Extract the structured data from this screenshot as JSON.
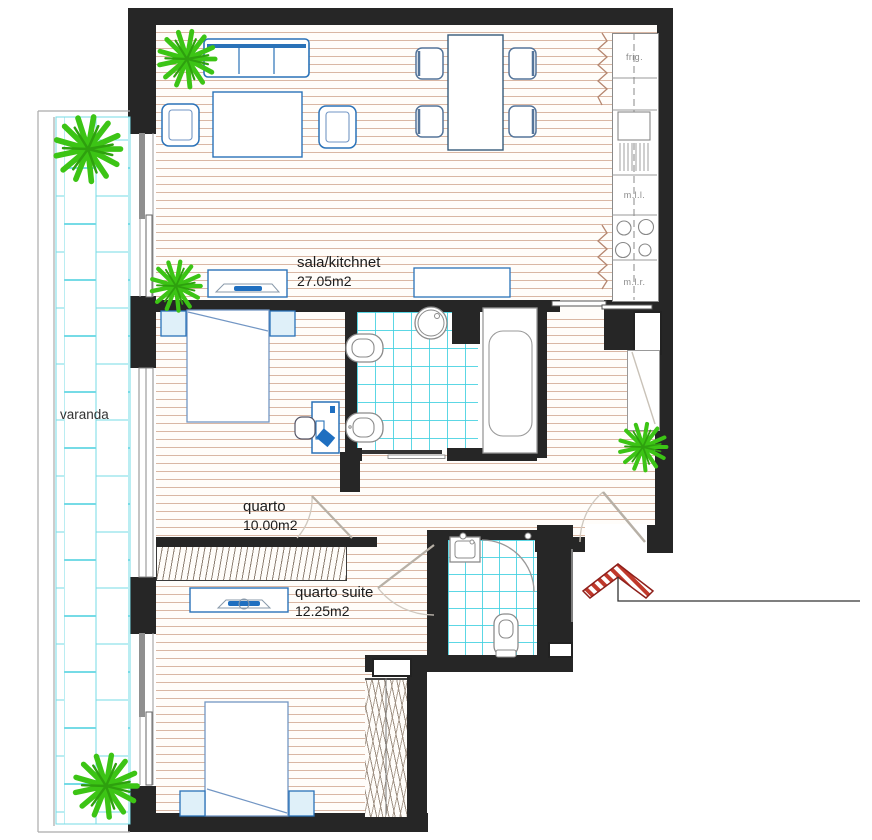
{
  "rooms": [
    {
      "name": "sala/kitchnet",
      "area": "27.05m2"
    },
    {
      "name": "quarto",
      "area": "10.00m2"
    },
    {
      "name": "quarto suite",
      "area": "12.25m2"
    },
    {
      "name": "varanda",
      "area": ""
    }
  ],
  "appliances": {
    "fridge": "frig.",
    "dishwasher": "m.l.l.",
    "washing_machine": "m.l.r."
  },
  "colors": {
    "wall": "#262626",
    "wood_line": "#d9b7a4",
    "tile_line": "#40d0e0",
    "furniture_blue": "#2a72b8",
    "plant_green": "#3cc415",
    "entry_arrow_red": "#c0392b"
  }
}
